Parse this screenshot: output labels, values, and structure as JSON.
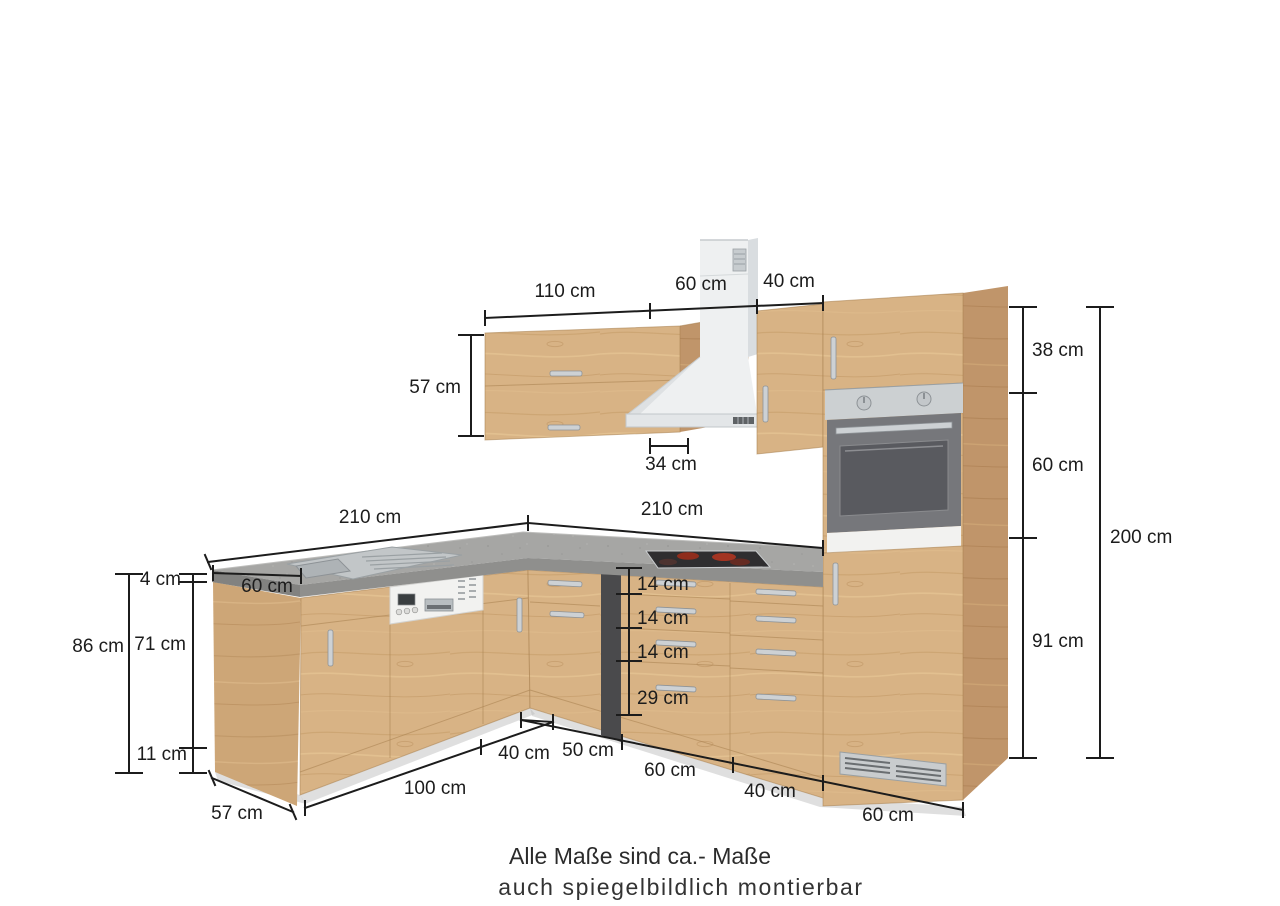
{
  "colors": {
    "wood-front": "#d8b385",
    "wood-side": "#c0956a",
    "wood-end": "#cda677",
    "wood-line": "#a87f4e",
    "counter-top": "#a6a6a4",
    "counter-front": "#8f8f8d",
    "counter-end": "#828280",
    "steel": "#ccd0d2",
    "steel-dark": "#9aa0a4",
    "appliance-white": "#f2f2f0",
    "oven-door": "#76777b",
    "oven-window": "#595a5f",
    "hood-white": "#eef0f1",
    "hood-shade": "#d9dde0",
    "cooktop": "#2f2e30",
    "burner-red": "#a23422",
    "dim": "#1c1c1c",
    "background": "#ffffff"
  },
  "dims": {
    "wall": {
      "w110": "110 cm",
      "w60": "60 cm",
      "w40": "40 cm",
      "h57": "57 cm",
      "d34": "34 cm"
    },
    "tall": {
      "s38": "38 cm",
      "s60": "60 cm",
      "s91": "91 cm",
      "total": "200 cm"
    },
    "worktop": {
      "left": "210 cm",
      "right": "210 cm",
      "depth": "60 cm"
    },
    "left": {
      "top": "4 cm",
      "total": "86 cm",
      "front": "71 cm",
      "plinth": "11 cm"
    },
    "drawers": {
      "d1": "14 cm",
      "d2": "14 cm",
      "d3": "14 cm",
      "d4": "29 cm"
    },
    "base": {
      "w100": "100 cm",
      "w40l": "40 cm",
      "w50": "50 cm",
      "w60": "60 cm",
      "w40r": "40 cm",
      "w60r": "60 cm",
      "depth57": "57 cm"
    }
  },
  "notes": {
    "line1": "Alle Maße sind ca.- Maße",
    "line2": "auch spiegelbildlich montierbar"
  }
}
